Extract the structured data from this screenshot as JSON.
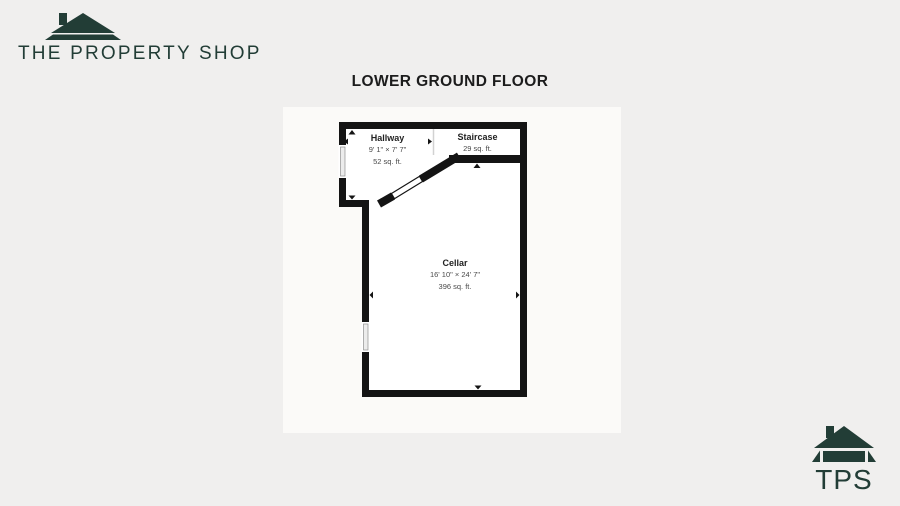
{
  "page": {
    "background": "#f0efee"
  },
  "brand": {
    "name": "THE PROPERTY SHOP",
    "color": "#223d36"
  },
  "plan": {
    "title": "LOWER GROUND FLOOR",
    "wall_color": "#141414",
    "rooms": {
      "hallway": {
        "name": "Hallway",
        "dims": "9' 1\" × 7' 7\"",
        "area": "52 sq. ft."
      },
      "staircase": {
        "name": "Staircase",
        "area": "29 sq. ft."
      },
      "cellar": {
        "name": "Cellar",
        "dims": "16' 10\" × 24' 7\"",
        "area": "396 sq. ft."
      }
    }
  },
  "footer": {
    "logo_text": "TPS"
  }
}
